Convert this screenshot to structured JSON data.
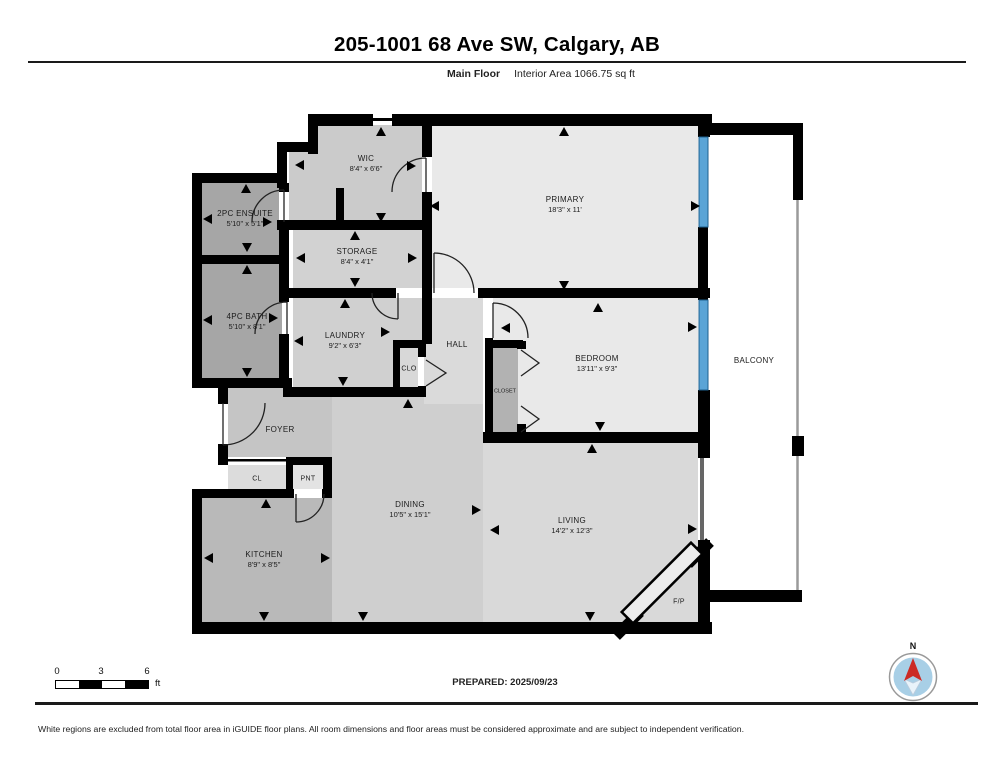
{
  "header": {
    "title": "205-1001 68 Ave SW, Calgary, AB",
    "floor_label": "Main Floor",
    "area_label": "Interior Area 1066.75 sq ft"
  },
  "rooms": {
    "wic": {
      "name": "WIC",
      "dims": "8'4\" x 6'6\""
    },
    "primary": {
      "name": "PRIMARY",
      "dims": "18'3\" x 11'"
    },
    "ensuite": {
      "name": "2PC ENSUITE",
      "dims": "5'10\" x 5'1\""
    },
    "storage": {
      "name": "STORAGE",
      "dims": "8'4\" x 4'1\""
    },
    "bath": {
      "name": "4PC BATH",
      "dims": "5'10\" x 8'1\""
    },
    "laundry": {
      "name": "LAUNDRY",
      "dims": "9'2\" x 6'3\""
    },
    "hall": {
      "name": "HALL"
    },
    "clo": {
      "name": "CLO"
    },
    "closet": {
      "name": "CLOSET"
    },
    "bedroom": {
      "name": "BEDROOM",
      "dims": "13'11\" x 9'3\""
    },
    "balcony": {
      "name": "BALCONY"
    },
    "foyer": {
      "name": "FOYER"
    },
    "cl": {
      "name": "CL"
    },
    "pnt": {
      "name": "PNT"
    },
    "kitchen": {
      "name": "KITCHEN",
      "dims": "8'9\" x 8'5\""
    },
    "dining": {
      "name": "DINING",
      "dims": "10'5\" x 15'1\""
    },
    "living": {
      "name": "LIVING",
      "dims": "14'2\" x 12'3\""
    },
    "fp": {
      "name": "F/P"
    }
  },
  "scale": {
    "t0": "0",
    "t1": "3",
    "t2": "6",
    "unit": "ft"
  },
  "compass": {
    "north_label": "N"
  },
  "footer": {
    "prepared": "PREPARED: 2025/09/23",
    "disclaimer": "White regions are excluded from total floor area in iGUIDE floor plans. All room dimensions and floor areas must be considered approximate and are subject to independent verification."
  },
  "colors": {
    "window_blue": "#5aa4d6",
    "compass_red": "#cc2a24",
    "wall_black": "#000000"
  }
}
